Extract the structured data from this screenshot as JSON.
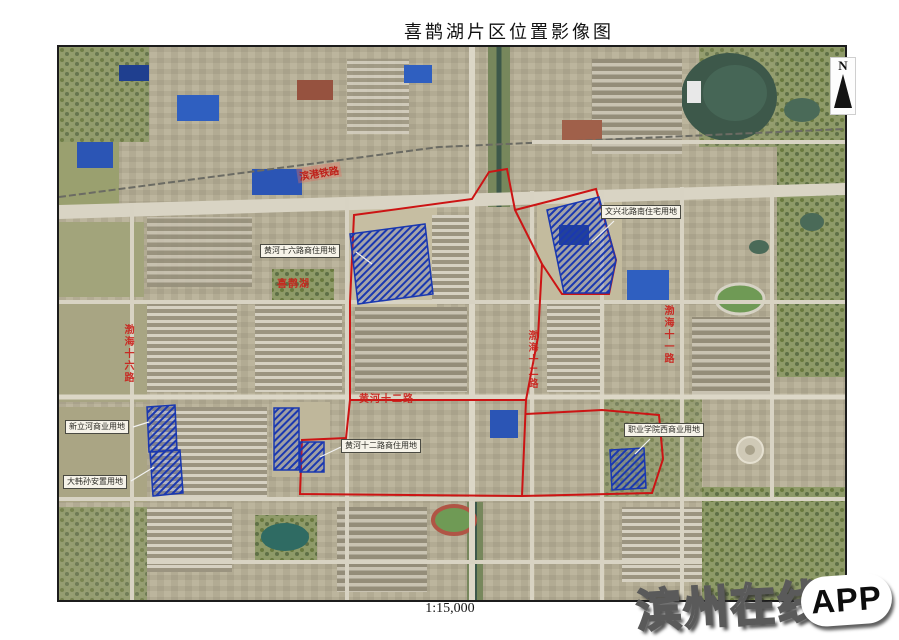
{
  "title": "喜鹊湖片区位置影像图",
  "scale": "1:15,000",
  "compass": "N",
  "watermark": {
    "brand": "滨州在线",
    "badge": "APP"
  },
  "parcel_labels": [
    "黄河十六路商住用地",
    "文兴北路南住宅用地",
    "新立河商业用地",
    "大韩孙安置用地",
    "黄河十二路商住用地",
    "职业学院西商业用地"
  ],
  "road_labels": {
    "railway": "滨港铁路",
    "bohai16": "渤海十六路",
    "xiquehu": "喜鹊湖",
    "bohai12": "渤海十二路",
    "bohai11": "渤海十一路",
    "huanghe12": "黄河十二路"
  },
  "colors": {
    "boundary_red": "#cc1414",
    "parcel_blue": "#1a38b0",
    "label_red": "#ca201a"
  }
}
